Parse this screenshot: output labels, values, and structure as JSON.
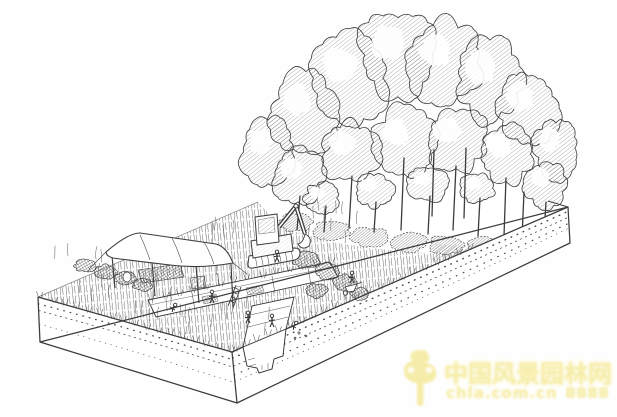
{
  "meta": {
    "title": "Pen-and-ink isometric illustration of an archaeological excavation: a cutaway soil block with grass, an open trench with workers and ladder, a canvas awning, a small tracked excavator, and a dense deciduous woodland",
    "medium": "black ink sketch on white paper"
  },
  "palette": {
    "paper": "#fefefe",
    "ink": "#3b3b3b",
    "ink_light": "#5a5a5a",
    "watermark_yellow": "#f6eca6"
  },
  "watermark": {
    "line1": "中国风景园林网",
    "line2": "chla.com.cn",
    "tagline_mark_count": 4
  },
  "scene": {
    "elements": [
      "soil-block",
      "stratigraphy-dots",
      "grass-meadow",
      "excavation-trench",
      "trench-steps",
      "ladder",
      "awning-tent",
      "work-tables",
      "excavator",
      "spoil-heaps",
      "shrubs",
      "forest",
      "tree-trunks",
      "field-workers",
      "wheelbarrow"
    ],
    "trees_back": [
      {
        "x": 268,
        "y": 152,
        "rx": 27,
        "ry": 33,
        "s": 0.75
      },
      {
        "x": 306,
        "y": 112,
        "rx": 33,
        "ry": 40,
        "s": 0.8
      },
      {
        "x": 350,
        "y": 78,
        "rx": 36,
        "ry": 44,
        "s": 0.7
      },
      {
        "x": 398,
        "y": 55,
        "rx": 38,
        "ry": 42,
        "s": 0.8
      },
      {
        "x": 446,
        "y": 62,
        "rx": 36,
        "ry": 42,
        "s": 0.7
      },
      {
        "x": 490,
        "y": 80,
        "rx": 34,
        "ry": 40,
        "s": 0.8
      },
      {
        "x": 528,
        "y": 108,
        "rx": 30,
        "ry": 36,
        "s": 0.7
      },
      {
        "x": 556,
        "y": 148,
        "rx": 22,
        "ry": 30,
        "s": 0.8
      }
    ],
    "trees_mid": [
      {
        "x": 298,
        "y": 176,
        "rx": 25,
        "ry": 26,
        "s": 0.65
      },
      {
        "x": 350,
        "y": 152,
        "rx": 29,
        "ry": 30,
        "s": 0.75
      },
      {
        "x": 404,
        "y": 142,
        "rx": 31,
        "ry": 33,
        "s": 0.7
      },
      {
        "x": 456,
        "y": 140,
        "rx": 30,
        "ry": 31,
        "s": 0.75
      },
      {
        "x": 506,
        "y": 154,
        "rx": 27,
        "ry": 29,
        "s": 0.7
      },
      {
        "x": 546,
        "y": 184,
        "rx": 20,
        "ry": 23,
        "s": 0.75
      }
    ],
    "trees_front": [
      {
        "x": 322,
        "y": 198,
        "rx": 17,
        "ry": 15,
        "s": 0.6
      },
      {
        "x": 374,
        "y": 190,
        "rx": 19,
        "ry": 17,
        "s": 0.65
      },
      {
        "x": 428,
        "y": 184,
        "rx": 19,
        "ry": 17,
        "s": 0.6
      },
      {
        "x": 478,
        "y": 188,
        "rx": 17,
        "ry": 15,
        "s": 0.65
      }
    ],
    "trunks": [
      [
        300,
        196,
        297,
        230
      ],
      [
        326,
        206,
        324,
        232
      ],
      [
        352,
        176,
        349,
        228
      ],
      [
        376,
        202,
        374,
        232
      ],
      [
        404,
        158,
        401,
        230
      ],
      [
        430,
        196,
        428,
        234
      ],
      [
        456,
        166,
        453,
        230
      ],
      [
        480,
        198,
        478,
        236
      ],
      [
        506,
        178,
        504,
        236
      ],
      [
        524,
        192,
        522,
        238
      ],
      [
        546,
        202,
        544,
        236
      ],
      [
        434,
        150,
        432,
        216
      ],
      [
        466,
        148,
        464,
        218
      ]
    ],
    "understory": [
      {
        "x": 296,
        "y": 222,
        "rx": 16,
        "ry": 9
      },
      {
        "x": 332,
        "y": 230,
        "rx": 18,
        "ry": 9
      },
      {
        "x": 370,
        "y": 237,
        "rx": 18,
        "ry": 9
      },
      {
        "x": 408,
        "y": 242,
        "rx": 18,
        "ry": 9
      },
      {
        "x": 446,
        "y": 245,
        "rx": 17,
        "ry": 9
      },
      {
        "x": 484,
        "y": 246,
        "rx": 16,
        "ry": 9
      },
      {
        "x": 520,
        "y": 243,
        "rx": 14,
        "ry": 8
      },
      {
        "x": 549,
        "y": 235,
        "rx": 11,
        "ry": 7
      }
    ],
    "shrubs": [
      {
        "x": 86,
        "y": 266,
        "rx": 11,
        "ry": 6
      },
      {
        "x": 105,
        "y": 272,
        "rx": 11,
        "ry": 7
      },
      {
        "x": 125,
        "y": 278,
        "rx": 10,
        "ry": 6
      },
      {
        "x": 143,
        "y": 285,
        "rx": 9,
        "ry": 6
      },
      {
        "x": 306,
        "y": 260,
        "rx": 13,
        "ry": 8
      },
      {
        "x": 327,
        "y": 271,
        "rx": 12,
        "ry": 8
      },
      {
        "x": 345,
        "y": 283,
        "rx": 11,
        "ry": 8
      },
      {
        "x": 317,
        "y": 291,
        "rx": 10,
        "ry": 7
      },
      {
        "x": 360,
        "y": 294,
        "rx": 9,
        "ry": 6
      }
    ],
    "figures": [
      {
        "x": 212,
        "y": 303,
        "h": 13,
        "pose": "stand"
      },
      {
        "x": 277,
        "y": 262,
        "h": 12,
        "pose": "stand"
      },
      {
        "x": 248,
        "y": 323,
        "h": 12,
        "pose": "stand"
      },
      {
        "x": 272,
        "y": 327,
        "h": 13,
        "pose": "stand"
      },
      {
        "x": 293,
        "y": 329,
        "h": 9,
        "pose": "bend"
      },
      {
        "x": 352,
        "y": 283,
        "h": 12,
        "pose": "stand"
      },
      {
        "x": 172,
        "y": 311,
        "h": 9,
        "pose": "bend"
      }
    ]
  }
}
